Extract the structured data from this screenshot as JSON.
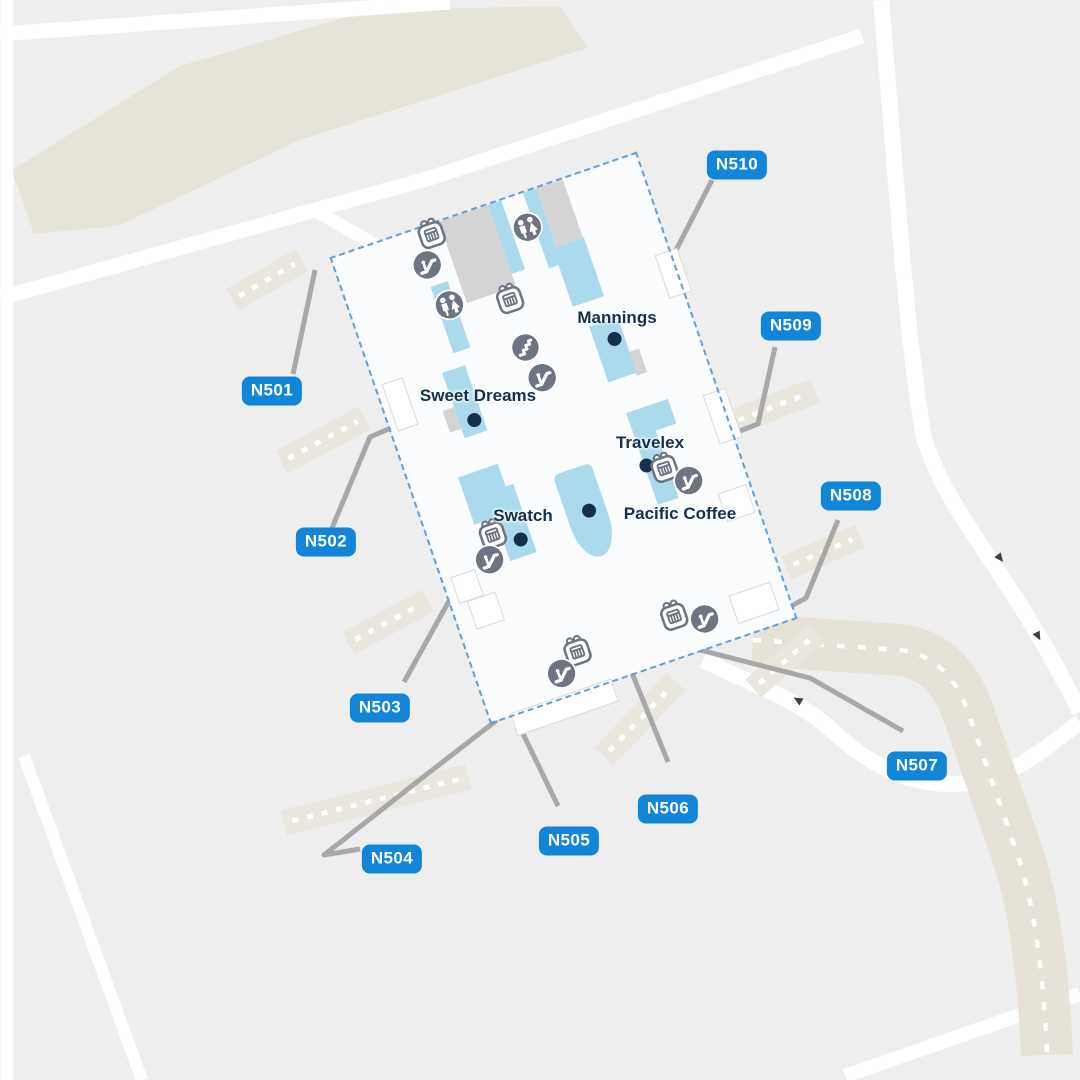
{
  "map": {
    "kind": "airport-concourse-map",
    "colors": {
      "background": "#eeeeee",
      "gate_label_bg": "#1186d9",
      "gate_label_text": "#ffffff",
      "store_text": "#15304e",
      "store_dot": "#15304e",
      "building_fill": "#fbfcfe",
      "building_outline": "#5f9fda",
      "shop_block_blue": "#abdaed",
      "block_gray": "#d4d4d4",
      "amenity_icon_gray": "#6d7582",
      "taxiway_beige": "#e7e2d8",
      "road_white": "#ffffff",
      "connector_gray": "#a8a8a8"
    }
  },
  "gates": [
    {
      "label": "N501",
      "x": 272,
      "y": 391
    },
    {
      "label": "N502",
      "x": 326,
      "y": 542
    },
    {
      "label": "N503",
      "x": 380,
      "y": 708
    },
    {
      "label": "N504",
      "x": 392,
      "y": 859
    },
    {
      "label": "N505",
      "x": 569,
      "y": 841
    },
    {
      "label": "N506",
      "x": 668,
      "y": 809
    },
    {
      "label": "N507",
      "x": 917,
      "y": 766
    },
    {
      "label": "N508",
      "x": 851,
      "y": 496
    },
    {
      "label": "N509",
      "x": 791,
      "y": 326
    },
    {
      "label": "N510",
      "x": 737,
      "y": 165
    }
  ],
  "stores": [
    {
      "name": "Mannings",
      "label_x": 617,
      "label_y": 318,
      "dot_x": 241,
      "dot_y": 168
    },
    {
      "name": "Sweet Dreams",
      "label_x": 478,
      "label_y": 396,
      "dot_x": 82,
      "dot_y": 199
    },
    {
      "name": "Travelex",
      "label_x": 650,
      "label_y": 443,
      "dot_x": 230,
      "dot_y": 298
    },
    {
      "name": "Swatch",
      "label_x": 523,
      "label_y": 516,
      "dot_x": 87,
      "dot_y": 327
    },
    {
      "name": "Pacific Coffee",
      "label_x": 680,
      "label_y": 514,
      "dot_x": 161,
      "dot_y": 322
    }
  ],
  "amenities": [
    {
      "type": "gift",
      "x": 102,
      "y": 8
    },
    {
      "type": "escalator",
      "x": 88,
      "y": 37
    },
    {
      "type": "restroom",
      "x": 195,
      "y": 34
    },
    {
      "type": "gift",
      "x": 155,
      "y": 95
    },
    {
      "type": "restroom",
      "x": 96,
      "y": 82
    },
    {
      "type": "stairs",
      "x": 154,
      "y": 147
    },
    {
      "type": "escalator",
      "x": 160,
      "y": 181
    },
    {
      "type": "gift",
      "x": 246,
      "y": 305
    },
    {
      "type": "escalator",
      "x": 265,
      "y": 326
    },
    {
      "type": "gift",
      "x": 62,
      "y": 312
    },
    {
      "type": "escalator",
      "x": 51,
      "y": 336
    },
    {
      "type": "gift",
      "x": 207,
      "y": 448
    },
    {
      "type": "escalator",
      "x": 235,
      "y": 462
    },
    {
      "type": "gift",
      "x": 104,
      "y": 450
    },
    {
      "type": "escalator",
      "x": 82,
      "y": 467
    }
  ]
}
